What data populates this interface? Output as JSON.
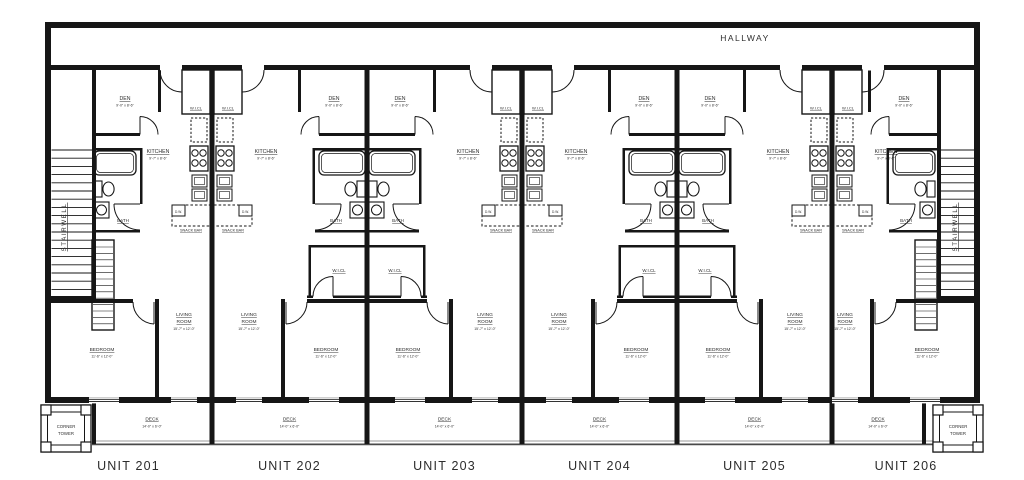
{
  "colors": {
    "ink": "#161616",
    "label": "#2e2e2e",
    "gray": "#9a9a9a",
    "rail_dark": "#4a4a4a",
    "unit_label": "#2c2c2c",
    "bg": "#ffffff"
  },
  "hallway": {
    "label": "HALLWAY"
  },
  "stairwell_left": {
    "label": "STAIRWELL"
  },
  "stairwell_right": {
    "label": "STAIRWELL"
  },
  "corner_tower_left": {
    "line1": "CORNER",
    "line2": "TOWER"
  },
  "corner_tower_right": {
    "line1": "CORNER",
    "line2": "TOWER"
  },
  "room_labels": {
    "den": {
      "label": "DEN",
      "dim": "9'-0\" x 8'-6\""
    },
    "kitchen": {
      "label": "KITCHEN",
      "dim": "9'-7\" x 8'-6\""
    },
    "bath": {
      "label": "BATH"
    },
    "walk_in_closet": {
      "label": "W.I.CL"
    },
    "living_room": {
      "line1": "LIVING",
      "line2": "ROOM",
      "dim": "15'-7\" x 12'-0\""
    },
    "bedroom": {
      "label": "BEDROOM",
      "dim": "11'-6\" x 12'-0\""
    },
    "deck": {
      "label": "DECK",
      "dim": "14'-0\" x 6'-0\""
    },
    "snack_bar": {
      "label": "SNACK BAR"
    },
    "dishwasher": {
      "label": "D.W."
    }
  },
  "units": [
    {
      "name": "UNIT 201"
    },
    {
      "name": "UNIT 202"
    },
    {
      "name": "UNIT 203"
    },
    {
      "name": "UNIT 204"
    },
    {
      "name": "UNIT 205"
    },
    {
      "name": "UNIT 206"
    }
  ]
}
